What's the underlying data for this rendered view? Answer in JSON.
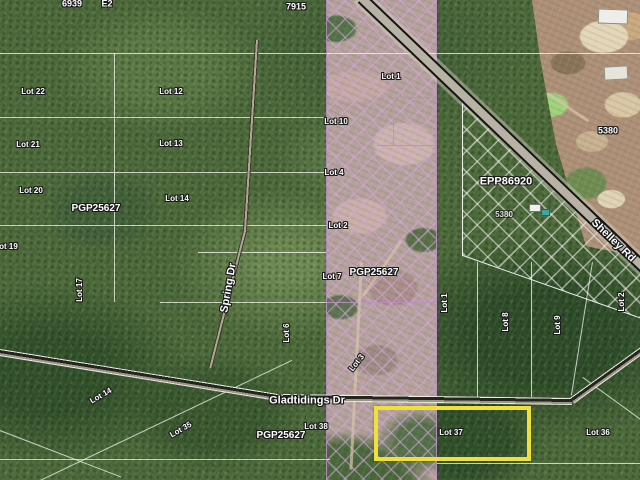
{
  "map": {
    "type": "aerial-parcel-map",
    "highlight": {
      "lot": "Lot 37",
      "color": "#f0e03a"
    },
    "hatch_colors": {
      "strip": "#d0a6d8",
      "epp_area": "#f2f2ec"
    },
    "labels": [
      {
        "name": "address-label",
        "text": "6939",
        "x": 72,
        "y": 4,
        "size": 9
      },
      {
        "name": "address-label",
        "text": "E2",
        "x": 107,
        "y": 4,
        "size": 9
      },
      {
        "name": "address-label",
        "text": "7915",
        "x": 296,
        "y": 7,
        "size": 9
      },
      {
        "name": "address-label",
        "text": "5380",
        "x": 608,
        "y": 131,
        "size": 9
      },
      {
        "name": "address-label",
        "text": "5380",
        "x": 504,
        "y": 215,
        "size": 8,
        "opacity": 0.75
      },
      {
        "name": "plan-label",
        "text": "PGP25627",
        "x": 96,
        "y": 209,
        "size": 10
      },
      {
        "name": "plan-label",
        "text": "PGP25627",
        "x": 374,
        "y": 273,
        "size": 10
      },
      {
        "name": "plan-label",
        "text": "PGP25627",
        "x": 281,
        "y": 436,
        "size": 10
      },
      {
        "name": "plan-label",
        "text": "EPP86920",
        "x": 506,
        "y": 182,
        "size": 11
      },
      {
        "name": "road-label",
        "text": "Spring Dr",
        "x": 229,
        "y": 288,
        "size": 11,
        "rot": -80
      },
      {
        "name": "road-label",
        "text": "Gladtidings Dr",
        "x": 307,
        "y": 401,
        "size": 11
      },
      {
        "name": "road-label",
        "text": "Shelley Rd",
        "x": 613,
        "y": 241,
        "size": 11,
        "rot": 44
      },
      {
        "name": "lot-label",
        "text": "Lot 22",
        "x": 33,
        "y": 92,
        "size": 8
      },
      {
        "name": "lot-label",
        "text": "Lot 21",
        "x": 28,
        "y": 145,
        "size": 8
      },
      {
        "name": "lot-label",
        "text": "Lot 20",
        "x": 31,
        "y": 191,
        "size": 8
      },
      {
        "name": "lot-label",
        "text": "Lot 19",
        "x": 6,
        "y": 247,
        "size": 8
      },
      {
        "name": "lot-label",
        "text": "Lot 17",
        "x": 80,
        "y": 290,
        "size": 8,
        "rot": -90
      },
      {
        "name": "lot-label",
        "text": "Lot 12",
        "x": 171,
        "y": 92,
        "size": 8
      },
      {
        "name": "lot-label",
        "text": "Lot 13",
        "x": 171,
        "y": 144,
        "size": 8
      },
      {
        "name": "lot-label",
        "text": "Lot 14",
        "x": 177,
        "y": 199,
        "size": 8
      },
      {
        "name": "lot-label",
        "text": "Lot 6",
        "x": 287,
        "y": 333,
        "size": 8,
        "rot": -90
      },
      {
        "name": "lot-label",
        "text": "Lot 1",
        "x": 391,
        "y": 77,
        "size": 8
      },
      {
        "name": "lot-label",
        "text": "Lot 10",
        "x": 336,
        "y": 122,
        "size": 8
      },
      {
        "name": "lot-label",
        "text": "Lot 4",
        "x": 334,
        "y": 173,
        "size": 8
      },
      {
        "name": "lot-label",
        "text": "Lot 2",
        "x": 338,
        "y": 226,
        "size": 8
      },
      {
        "name": "lot-label",
        "text": "Lot 7",
        "x": 332,
        "y": 277,
        "size": 8
      },
      {
        "name": "lot-label",
        "text": "Lot 3",
        "x": 357,
        "y": 363,
        "size": 8,
        "rot": -52
      },
      {
        "name": "lot-label",
        "text": "Lot 1",
        "x": 445,
        "y": 303,
        "size": 8,
        "rot": -90
      },
      {
        "name": "lot-label",
        "text": "Lot 8",
        "x": 506,
        "y": 322,
        "size": 8,
        "rot": -90
      },
      {
        "name": "lot-label",
        "text": "Lot 9",
        "x": 558,
        "y": 325,
        "size": 8,
        "rot": -90
      },
      {
        "name": "lot-label",
        "text": "Lot 2",
        "x": 622,
        "y": 302,
        "size": 8,
        "rot": -90
      },
      {
        "name": "lot-label",
        "text": "Lot 14",
        "x": 101,
        "y": 396,
        "size": 8,
        "rot": -30
      },
      {
        "name": "lot-label",
        "text": "Lot 35",
        "x": 181,
        "y": 430,
        "size": 8,
        "rot": -30
      },
      {
        "name": "lot-label",
        "text": "Lot 38",
        "x": 316,
        "y": 427,
        "size": 8
      },
      {
        "name": "lot-label",
        "text": "Lot 37",
        "x": 451,
        "y": 433,
        "size": 8
      },
      {
        "name": "lot-label",
        "text": "Lot 36",
        "x": 598,
        "y": 433,
        "size": 8
      }
    ]
  }
}
